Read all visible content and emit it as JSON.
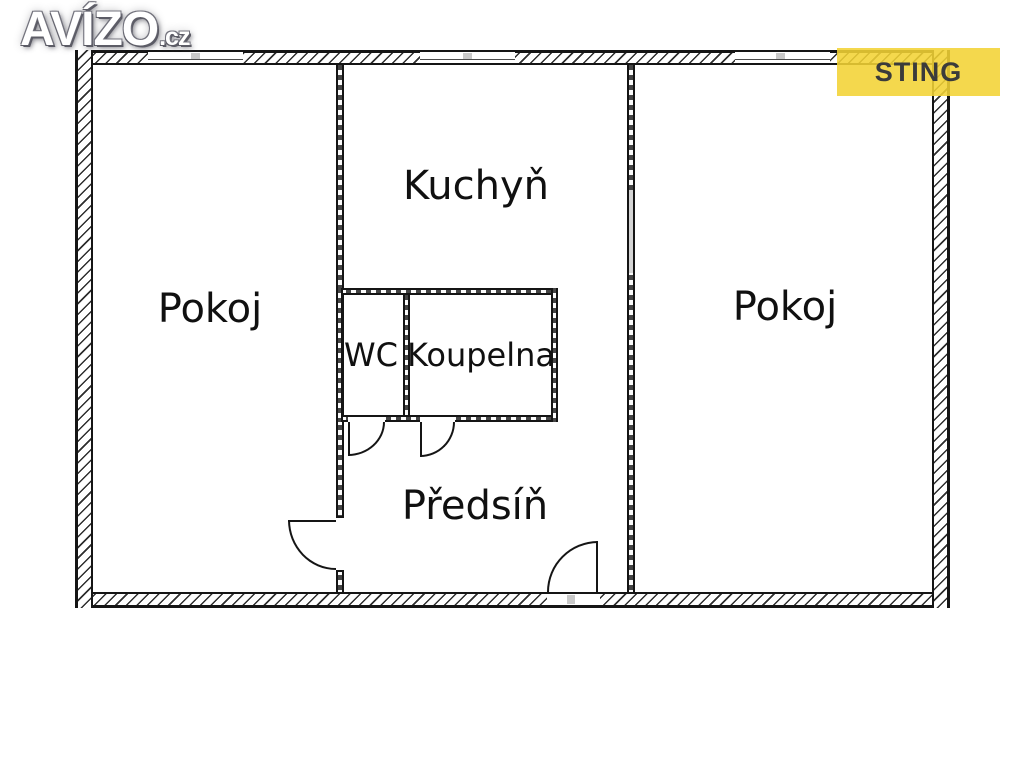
{
  "logo": {
    "brand": "AVÍZO",
    "tld": ".cz"
  },
  "badge": {
    "label": "STING",
    "background": "#f2d334",
    "text_color": "#3b3b3b"
  },
  "rooms": {
    "pokoj_left": "Pokoj",
    "kuchyn": "Kuchyň",
    "wc": "WC",
    "koupelna": "Koupelna",
    "predsin": "Předsíň",
    "pokoj_right": "Pokoj"
  },
  "colors": {
    "wall_line": "#151515",
    "label_text": "#101010",
    "window_tick": "#c9c9c9",
    "wall_opening_fill": "#d4d4d4",
    "background": "#ffffff"
  }
}
